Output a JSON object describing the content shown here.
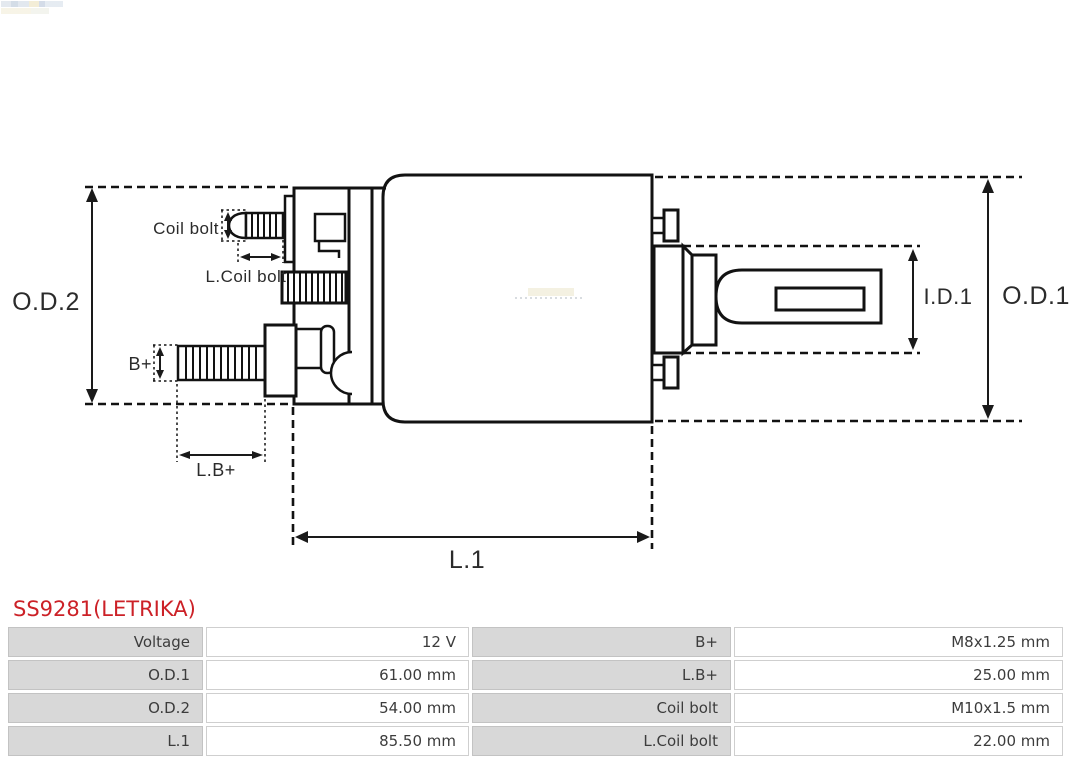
{
  "title": {
    "text": "SS9281(LETRIKA)",
    "color": "#cc2127"
  },
  "diagram": {
    "line_color": "#121212",
    "labels": {
      "od2": "O.D.2",
      "od1": "O.D.1",
      "id1": "I.D.1",
      "l1": "L.1",
      "coil_bolt": "Coil bolt",
      "l_coil_bolt": "L.Coil bolt",
      "b_plus": "B+",
      "l_b_plus": "L.B+"
    }
  },
  "table": {
    "rows": [
      {
        "c0": "Voltage",
        "c1": "12 V",
        "c2": "B+",
        "c3": "M8x1.25 mm"
      },
      {
        "c0": "O.D.1",
        "c1": "61.00 mm",
        "c2": "L.B+",
        "c3": "25.00 mm"
      },
      {
        "c0": "O.D.2",
        "c1": "54.00 mm",
        "c2": "Coil bolt",
        "c3": "M10x1.5 mm"
      },
      {
        "c0": "L.1",
        "c1": "85.50 mm",
        "c2": "L.Coil bolt",
        "c3": "22.00 mm"
      }
    ]
  }
}
